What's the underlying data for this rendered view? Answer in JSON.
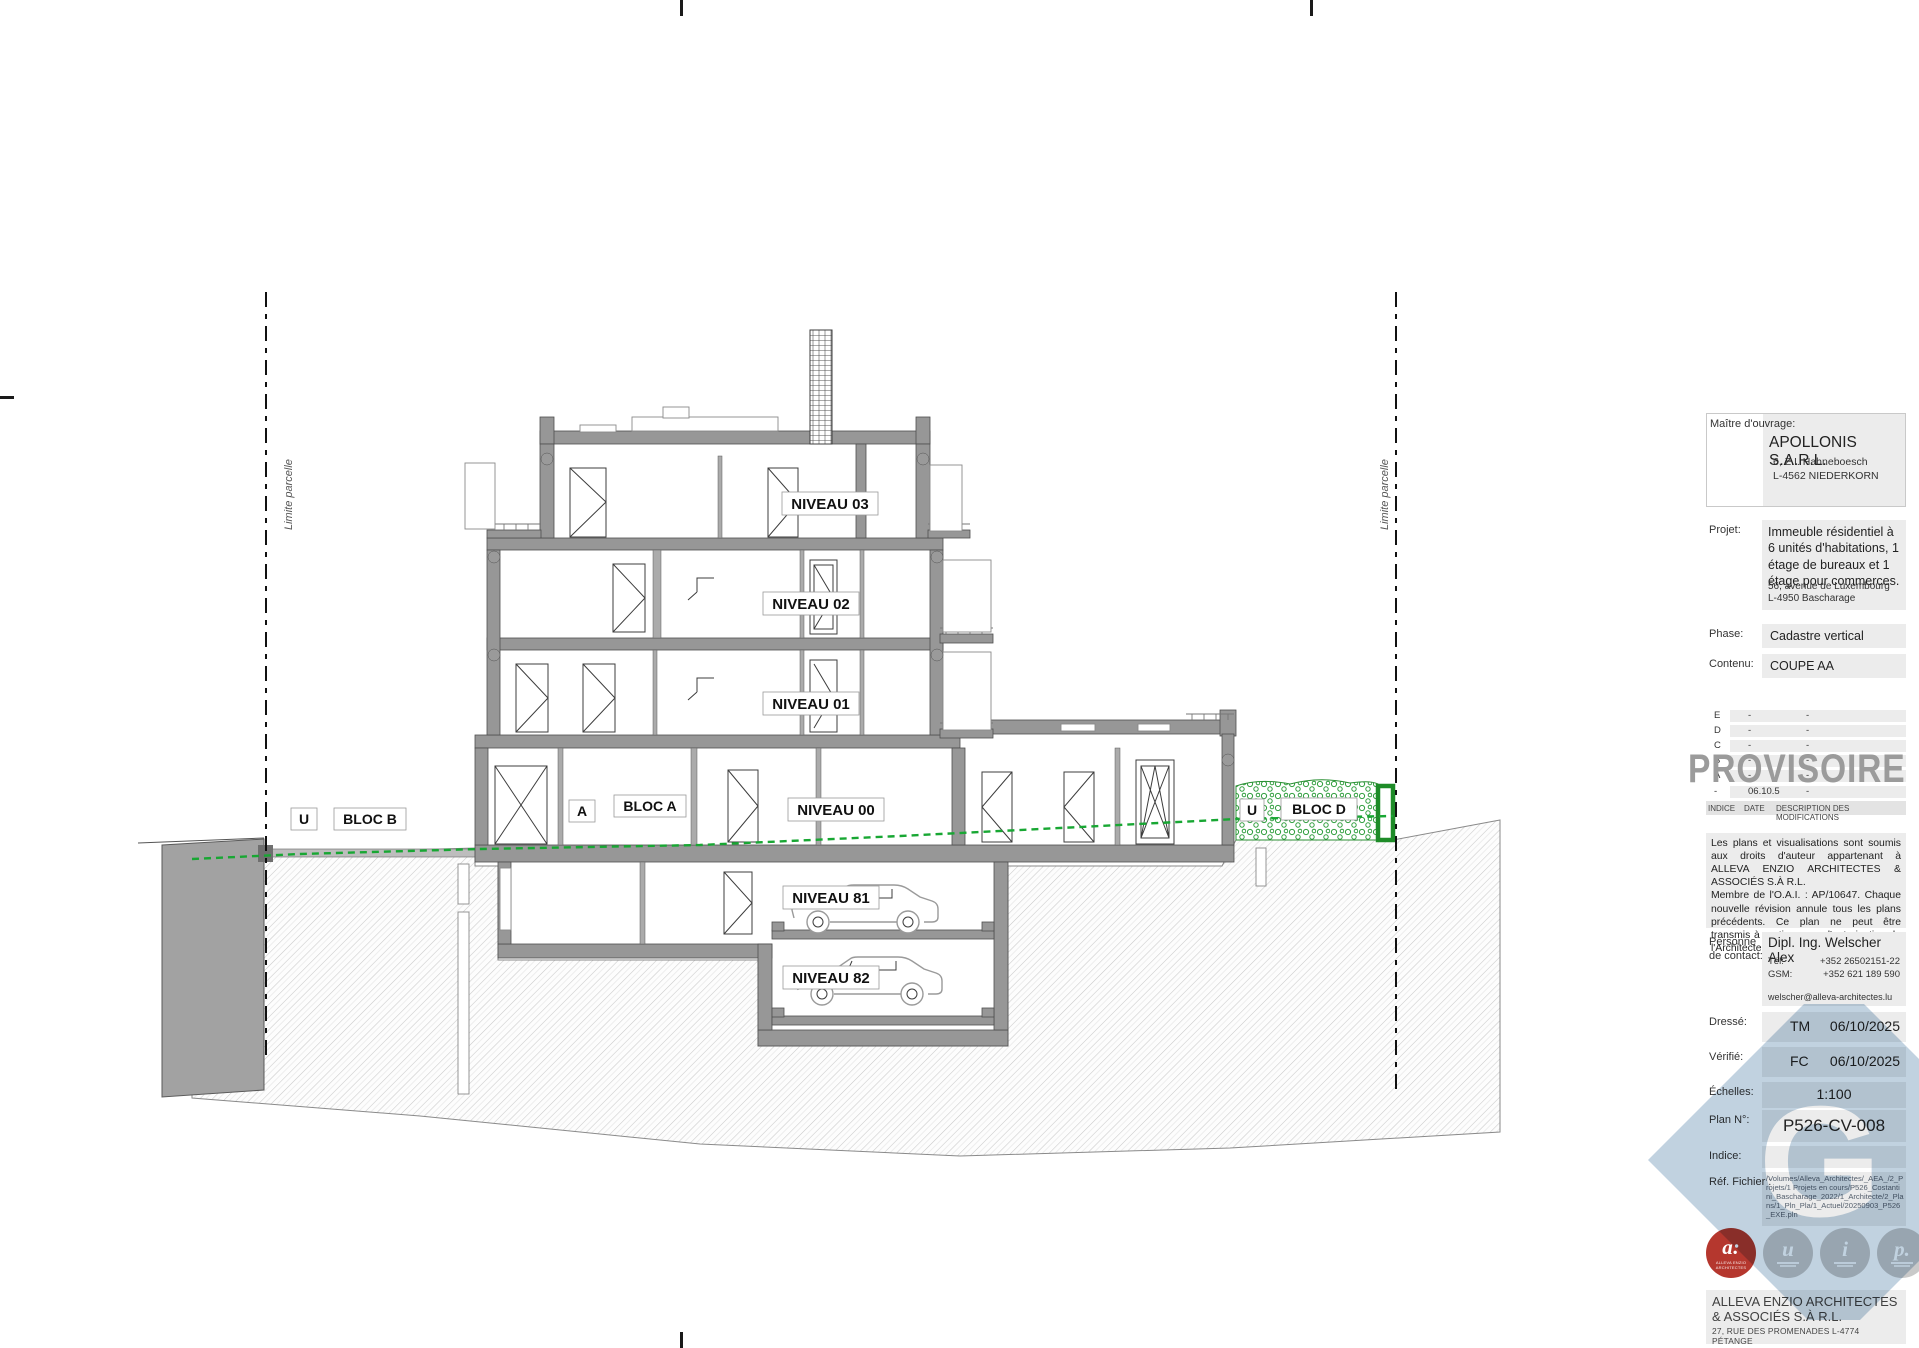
{
  "drawing": {
    "parcel_label_left": "Limite parcelle",
    "parcel_label_right": "Limite parcelle",
    "levels": {
      "n03": "NIVEAU 03",
      "n02": "NIVEAU 02",
      "n01": "NIVEAU 01",
      "n00": "NIVEAU 00",
      "n81": "NIVEAU 81",
      "n82": "NIVEAU 82"
    },
    "blocs": {
      "u_left": "U",
      "bloc_b": "BLOC B",
      "a": "A",
      "bloc_a": "BLOC A",
      "u_right": "U",
      "bloc_d": "BLOC D"
    },
    "colors": {
      "terrain_line": "#18a733",
      "hedge": "#2f9e3d",
      "wall": "#979797",
      "watermark": "#b6cadb",
      "stamp": "#9b9b9b",
      "logo_red": "#b5372e"
    }
  },
  "titleblock": {
    "maitre_ouvrage": {
      "label": "Maître d'ouvrage:",
      "name": "APOLLONIS S.A.R.L.",
      "address1": "6, Z.I. Hahneboesch",
      "address2": "L-4562 NIEDERKORN"
    },
    "projet": {
      "label": "Projet:",
      "description": "Immeuble résidentiel à 6 unités d'habitations, 1 étage de bureaux et 1 étage pour commerces.",
      "address1": "56, avenue de Luxembourg",
      "address2": "L-4950 Bascharage"
    },
    "phase": {
      "label": "Phase:",
      "value": "Cadastre vertical"
    },
    "contenu": {
      "label": "Contenu:",
      "value": "COUPE AA"
    },
    "revisions": {
      "rows": [
        {
          "indice": "E",
          "date": "-",
          "desc": "-"
        },
        {
          "indice": "D",
          "date": "-",
          "desc": "-"
        },
        {
          "indice": "C",
          "date": "-",
          "desc": "-"
        },
        {
          "indice": "B",
          "date": "-",
          "desc": "-"
        },
        {
          "indice": "A",
          "date": "-",
          "desc": "-"
        },
        {
          "indice": "-",
          "date": "06.10.5",
          "desc": "-"
        }
      ],
      "header": {
        "indice": "INDICE",
        "date": "DATE",
        "desc": "DESCRIPTION DES MODIFICATIONS"
      }
    },
    "stamp": "PROVISOIRE",
    "copyright": "Les plans et visualisations sont soumis aux droits d'auteur appartenant à ALLEVA ENZIO ARCHITECTES & ASSOCIÉS S.À R.L.\nMembre de l'O.A.I. : AP/10647. Chaque nouvelle révision annule tous les plans précédents. Ce plan ne peut être transmis à un tiers sans l'autorisation de l'Architecte.",
    "contact": {
      "label": "Personne\nde contact:",
      "name": "Dipl. Ing. Welscher Alex",
      "tel_label": "Tél:",
      "tel": "+352 26502151-22",
      "gsm_label": "GSM:",
      "gsm": "+352 621 189 590",
      "email": "welscher@alleva-architectes.lu"
    },
    "dresse": {
      "label": "Dressé:",
      "initials": "TM",
      "date": "06/10/2025"
    },
    "verifie": {
      "label": "Vérifié:",
      "initials": "FC",
      "date": "06/10/2025"
    },
    "echelles": {
      "label": "Échelles:",
      "value": "1:100"
    },
    "plan_no": {
      "label": "Plan N°:",
      "value": "P526-CV-008"
    },
    "indice": {
      "label": "Indice:",
      "value": ""
    },
    "ref_fichier": {
      "label": "Réf. Fichier :",
      "value": "/Volumes/Alleva_Architectes/_AEA_/2_Projets/1 Projets en cours/P526_Costantini_Bascharage_2022/1_Architecte/2_Plans/1_Pln_Pla/1_Actuel/20250903_P526_EXE.pln"
    },
    "logos": [
      {
        "letter": "a:",
        "caption": "ALLEVA ENZIO ARCHITECTES"
      },
      {
        "letter": "u"
      },
      {
        "letter": "i"
      },
      {
        "letter": "p."
      }
    ],
    "firm": {
      "name1": "ALLEVA ENZIO ARCHITECTES",
      "name2": "& ASSOCIÉS S.À R.L.",
      "address": "27, RUE DES PROMENADES   L-4774 PÉTANGE",
      "website": "ALLEVA-ARCHITECTES.LU"
    },
    "watermark_letter": "G"
  }
}
